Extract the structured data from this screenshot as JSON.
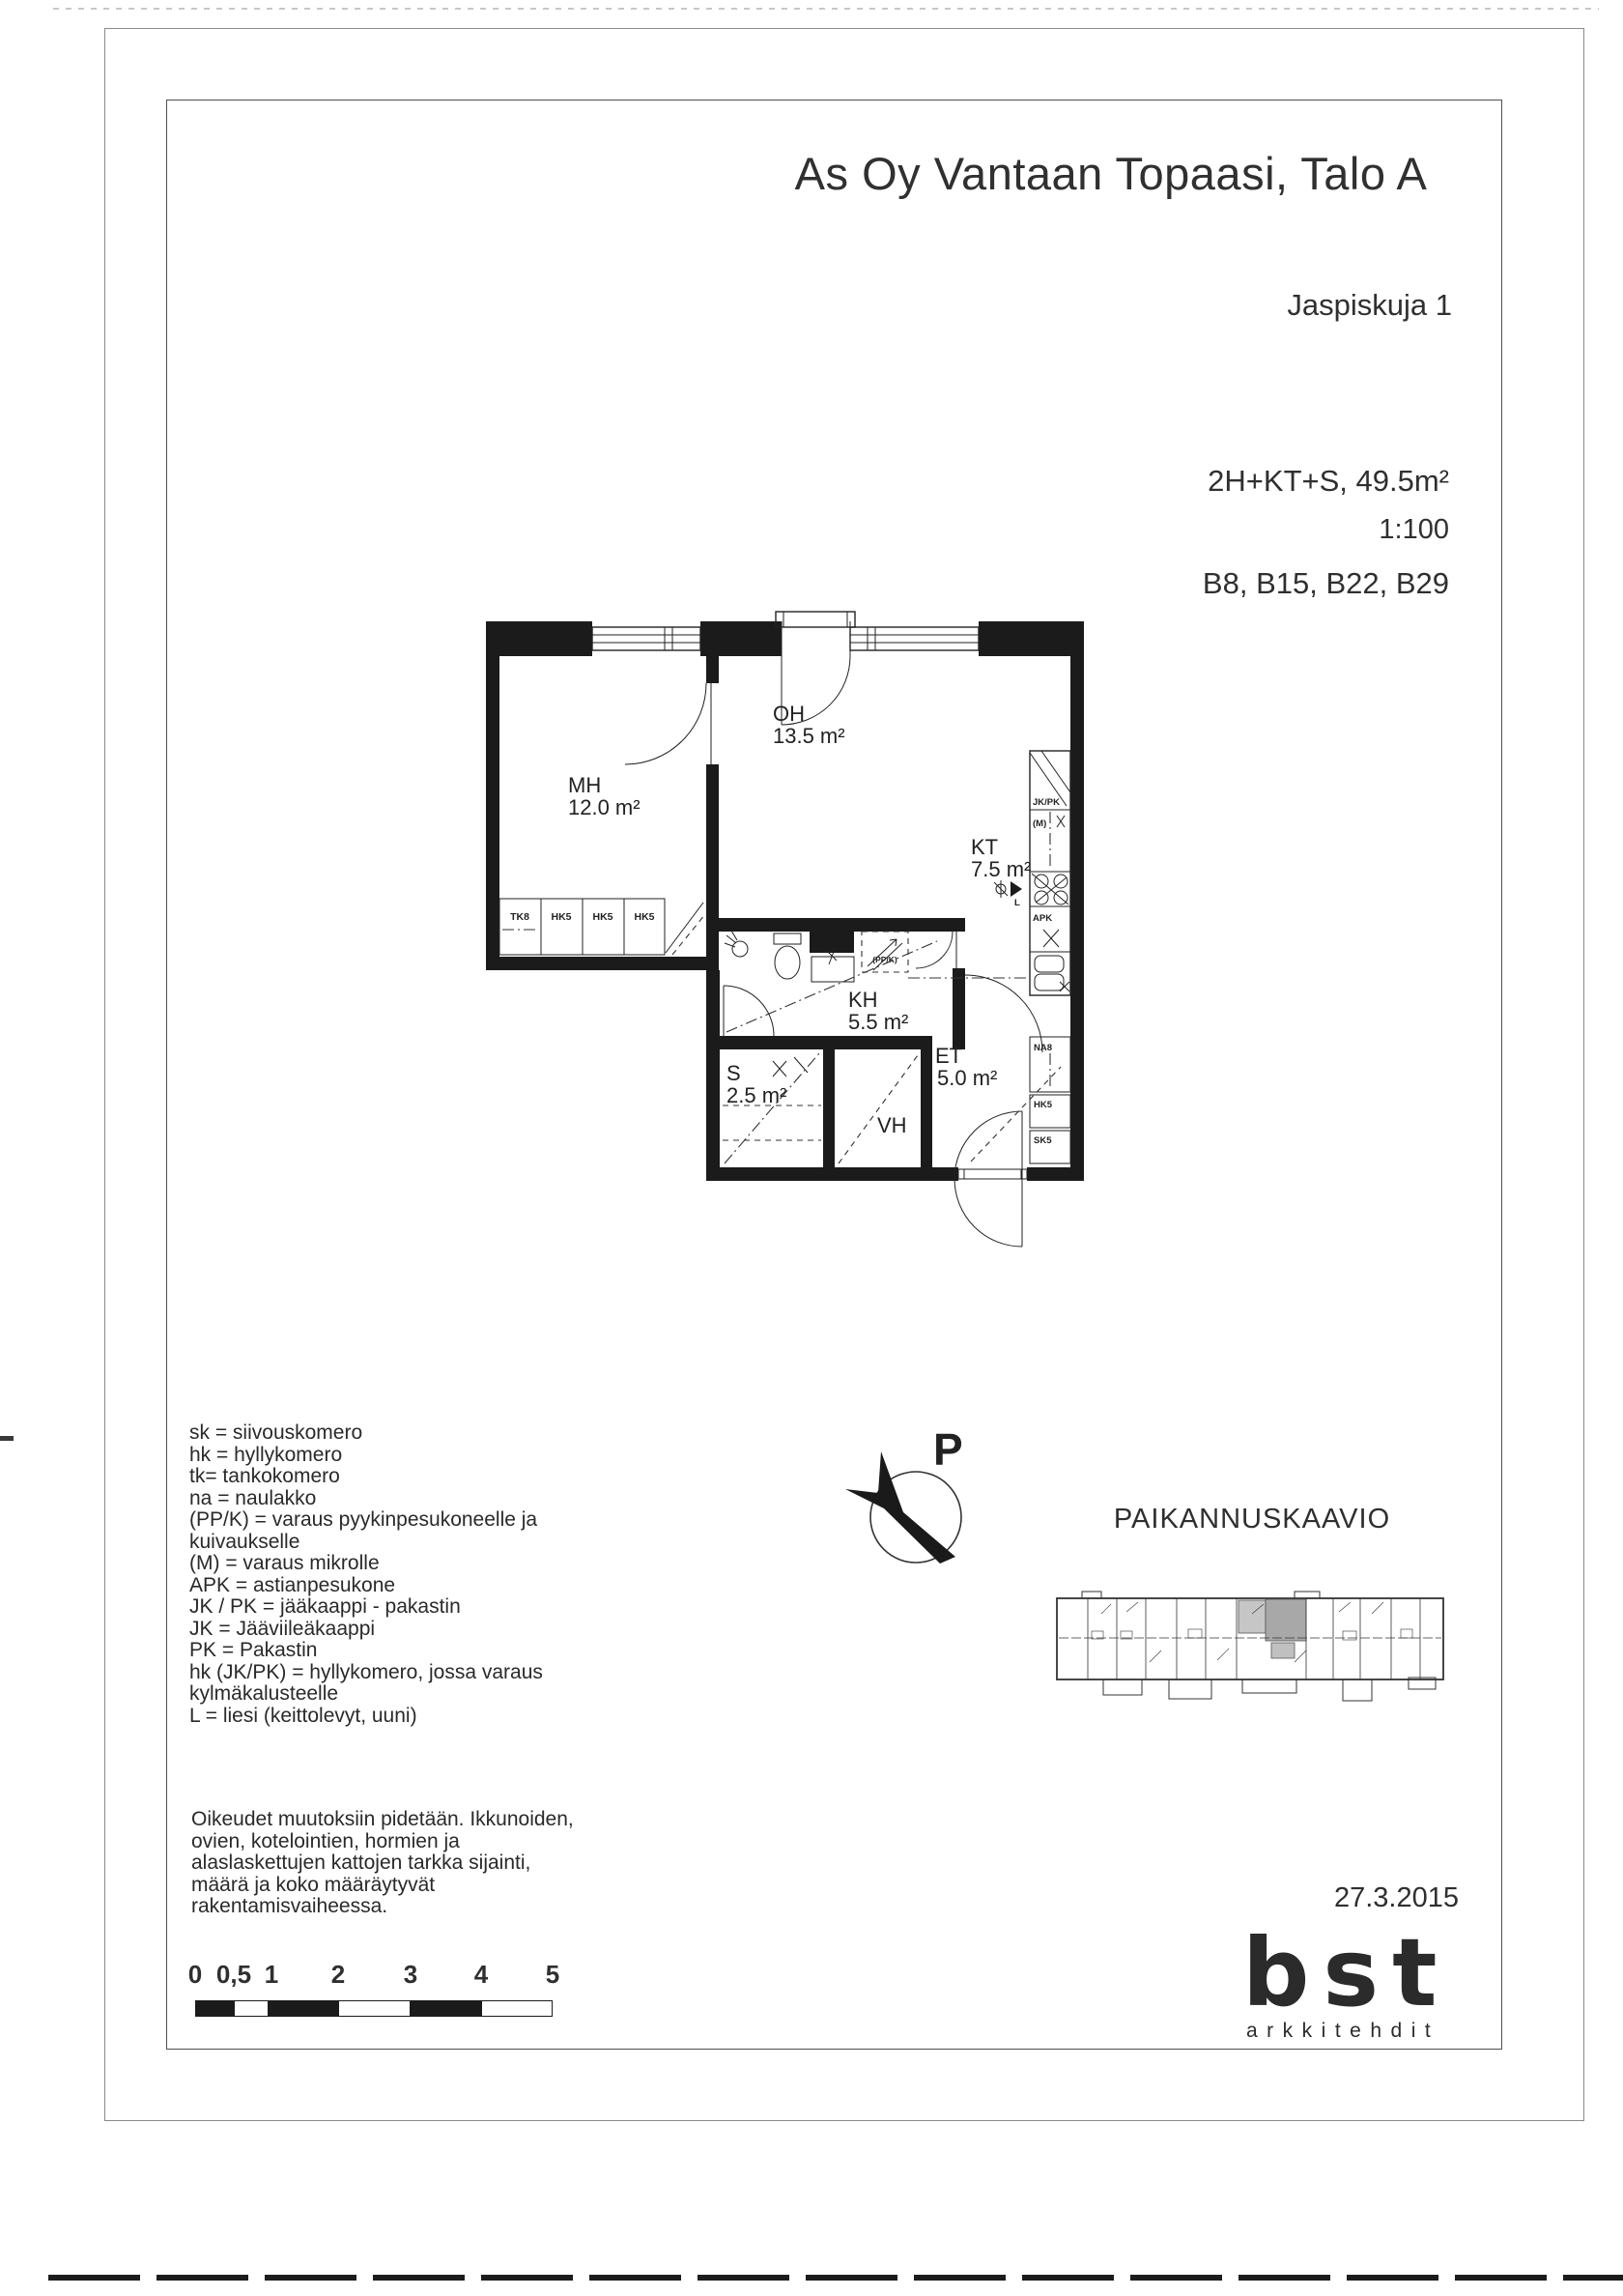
{
  "header": {
    "title": "As Oy Vantaan Topaasi, Talo A",
    "address": "Jaspiskuja 1"
  },
  "info": {
    "apartment_type": "2H+KT+S, 49.5m²",
    "drawing_scale": "1:100",
    "apartment_units": "B8, B15, B22, B29",
    "date": "27.3.2015"
  },
  "floorplan": {
    "rooms": [
      {
        "abbr": "MH",
        "area": "12.0 m²"
      },
      {
        "abbr": "OH",
        "area": "13.5 m²"
      },
      {
        "abbr": "KT",
        "area": "7.5 m²"
      },
      {
        "abbr": "KH",
        "area": "5.5 m²"
      },
      {
        "abbr": "S",
        "area": "2.5 m²"
      },
      {
        "abbr": "VH",
        "area": ""
      },
      {
        "abbr": "ET",
        "area": "5.0 m²"
      }
    ],
    "labels": {
      "jkpk": "JK/PK",
      "m": "(M)",
      "l": "L",
      "apk": "APK",
      "ppk": "(PP/K)"
    },
    "closets_mh": [
      "TK8",
      "HK5",
      "HK5",
      "HK5"
    ],
    "closets_et": [
      "NA8",
      "HK5",
      "SK5"
    ],
    "wall_color": "#1b1b1b"
  },
  "legend": {
    "lines": [
      "sk = siivouskomero",
      "hk = hyllykomero",
      "tk= tankokomero",
      "na = naulakko",
      "(PP/K) = varaus pyykinpesukoneelle ja",
      "kuivaukselle",
      "(M) = varaus mikrolle",
      "APK = astianpesukone",
      "JK / PK = jääkaappi - pakastin",
      "JK = Jääviileäkaappi",
      "PK = Pakastin",
      "hk (JK/PK) = hyllykomero, jossa varaus",
      "kylmäkalusteelle",
      "L = liesi (keittolevyt, uuni)"
    ]
  },
  "north": {
    "label": "P"
  },
  "location_diagram": {
    "title": "PAIKANNUSKAAVIO",
    "highlight_color": "#a8a8a8"
  },
  "disclaimer": {
    "lines": [
      "Oikeudet muutoksiin pidetään. Ikkunoiden,",
      "ovien, kotelointien, hormien ja",
      "alaslaskettujen kattojen tarkka sijainti,",
      "määrä ja koko määräytyvät",
      "rakentamisvaiheessa."
    ]
  },
  "scalebar": {
    "labels": [
      "0",
      "0,5",
      "1",
      "2",
      "3",
      "4",
      "5"
    ]
  },
  "logo": {
    "name": "bst",
    "tagline": "arkkitehdit"
  }
}
